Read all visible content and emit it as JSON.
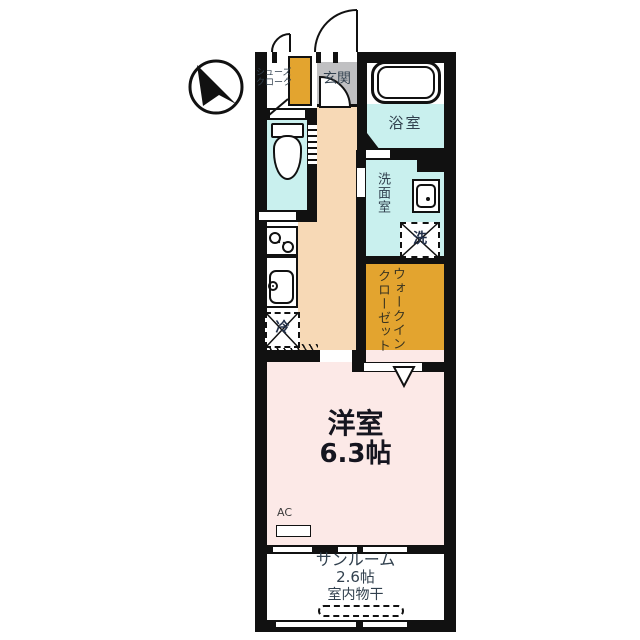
{
  "rooms": {
    "entrance": {
      "label": "玄関"
    },
    "shoes_closet": {
      "line1": "シューズ",
      "line2": "クローク"
    },
    "bathroom": {
      "label": "浴室"
    },
    "washroom": {
      "label": "洗面室"
    },
    "washer_space": {
      "label": "洗"
    },
    "walk_in_closet": {
      "line1": "ウォークイン",
      "line2": "クローゼット"
    },
    "refrigerator_space": {
      "label": "冷"
    },
    "western_room": {
      "label": "洋室",
      "size": "6.3帖"
    },
    "air_conditioner": {
      "label": "AC"
    },
    "sunroom": {
      "label": "サンルーム",
      "size": "2.6帖",
      "note": "室内物干"
    }
  },
  "icons": {
    "compass": "north-arrow",
    "bathtub": "bathtub-icon",
    "toilet": "toilet-icon",
    "washbasin": "washbasin-icon",
    "stove": "gas-stove-icon",
    "kitchen_sink": "kitchen-sink-icon"
  },
  "colors": {
    "wall": "#111111",
    "water_rooms": "#c9f0ee",
    "hall": "#f7d9b6",
    "western_room": "#fce9e7",
    "closet_orange": "#e3a42f",
    "entrance_gray": "#c0c0c2",
    "label_text": "#31404e",
    "room_title_text": "#15151f"
  }
}
